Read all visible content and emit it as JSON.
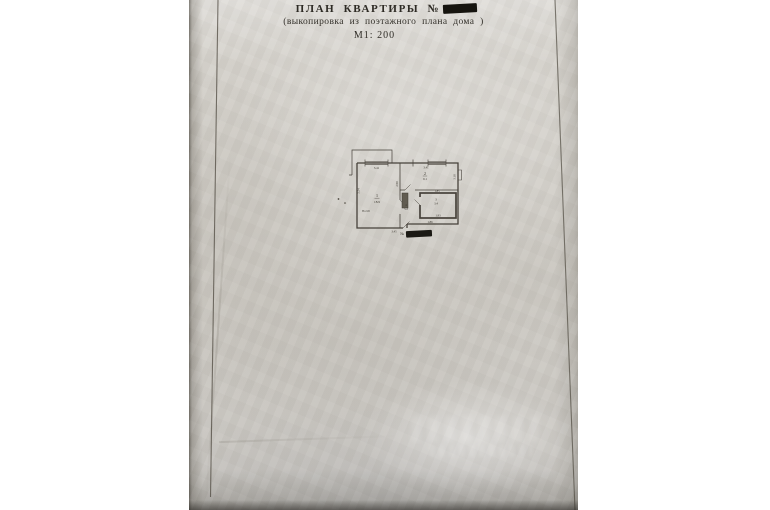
{
  "header": {
    "title": "ПЛАН  КВАРТИРЫ  №",
    "subtitle": "(выкопировка  из  поэтажного  плана  дома )",
    "scale_label": "М1: 200",
    "title_number_redacted": true
  },
  "plan": {
    "rooms": [
      {
        "number": "1",
        "area": "18.9",
        "height_note": "Н=2.65"
      },
      {
        "number": "2",
        "area": "9.1"
      },
      {
        "number": "3",
        "area": "3.4"
      },
      {
        "number": "4",
        "area": "5.2"
      }
    ],
    "dimensions": {
      "top_left": "3.41",
      "top_right": "3.41",
      "left_wall": "5.54",
      "middle_wall": "2.90",
      "right_wall": "3.18",
      "above_bathroom": "1.85",
      "bathroom_bottom": "1.93",
      "below_bathroom": "1.86",
      "bottom": "3.45"
    },
    "apartment_number_label": "№",
    "plan_number_redacted": true
  },
  "watermark": {
    "legible": false
  }
}
